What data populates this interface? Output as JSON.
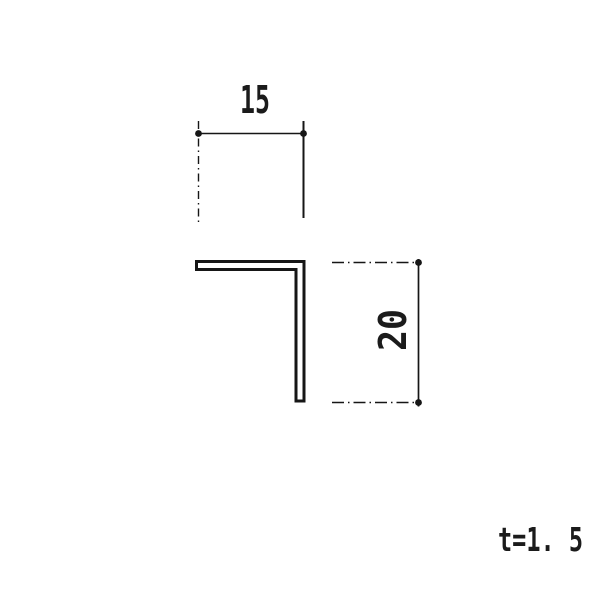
{
  "page": {
    "background": "#ffffff",
    "ink_color": "#161616"
  },
  "drawing": {
    "type": "cross-section-angle-profile",
    "dimensions": {
      "width": {
        "value": 15,
        "label": "15"
      },
      "height": {
        "value": 20,
        "label": "20"
      },
      "thickness": {
        "value": 1.5,
        "label": "t=1. 5"
      }
    }
  }
}
